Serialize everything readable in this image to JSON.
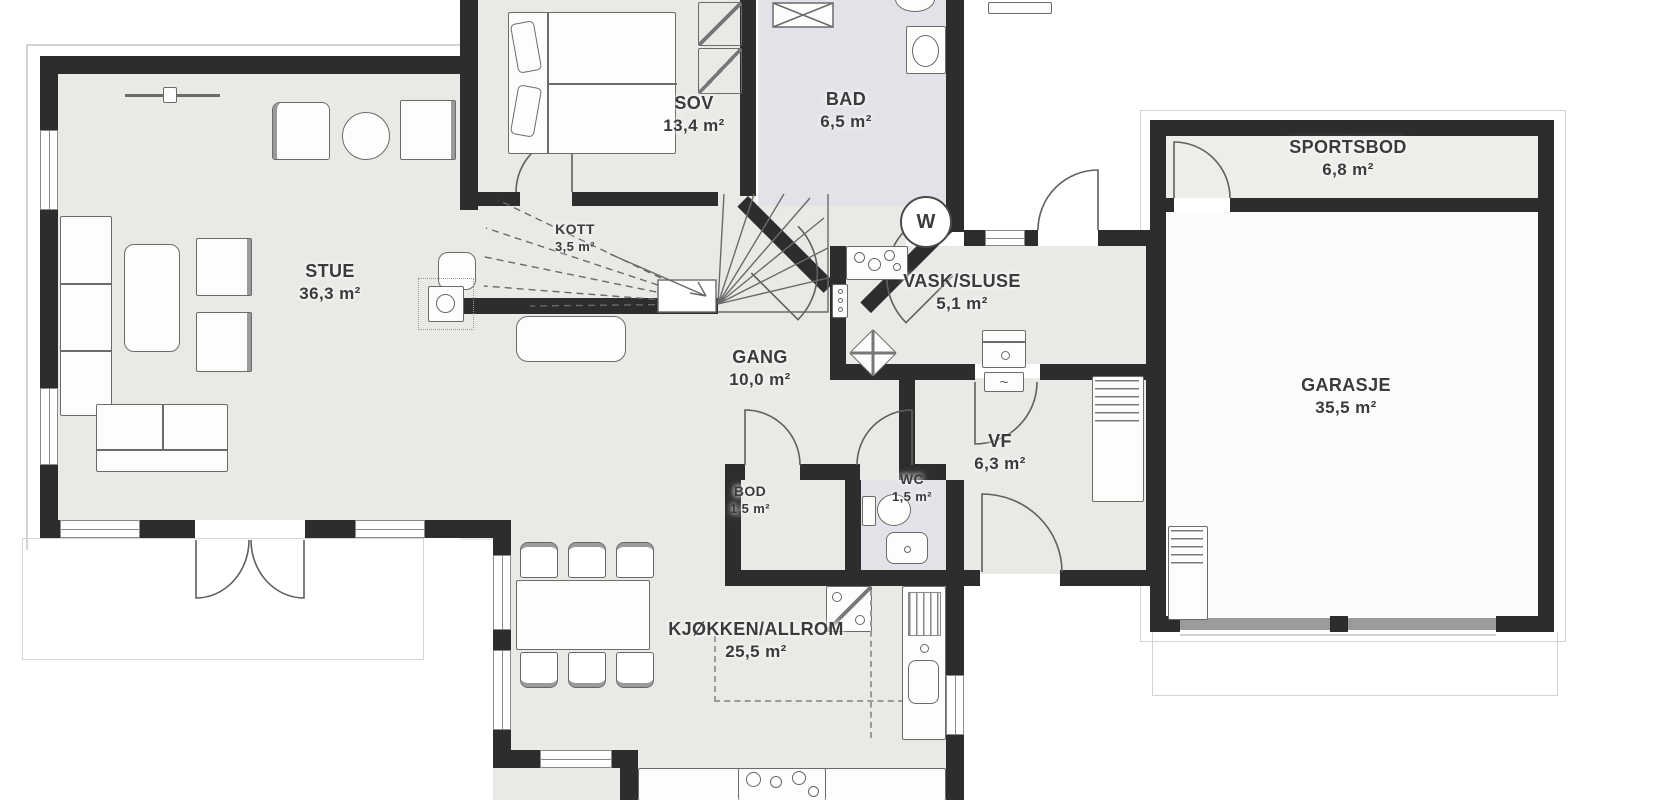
{
  "rooms": {
    "stue": {
      "label": "STUE",
      "area": "36,3 m²"
    },
    "sov": {
      "label": "SOV",
      "area": "13,4 m²"
    },
    "bad": {
      "label": "BAD",
      "area": "6,5 m²"
    },
    "kott": {
      "label": "KOTT",
      "area": "3,5 m²"
    },
    "gang": {
      "label": "GANG",
      "area": "10,0 m²"
    },
    "vask": {
      "label": "VASK/SLUSE",
      "area": "5,1 m²"
    },
    "vf": {
      "label": "VF",
      "area": "6,3 m²"
    },
    "wc": {
      "label": "WC",
      "area": "1,5 m²"
    },
    "bod": {
      "label": "BOD",
      "area": "1,5 m²"
    },
    "kjokken": {
      "label": "KJØKKEN/ALLROM",
      "area": "25,5 m²"
    },
    "sportsbod": {
      "label": "SPORTSBOD",
      "area": "6,8 m²"
    },
    "garasje": {
      "label": "GARASJE",
      "area": "35,5 m²"
    }
  },
  "symbols": {
    "washing_machine": "W"
  },
  "colors": {
    "wall": "#2d2d2d",
    "floor": "#e9e9e6",
    "wet_room_floor": "#e2e3e8",
    "garage_floor": "#fbfbf9",
    "sportsbod_floor": "#ededea",
    "outside": "#ffffff",
    "furniture_line": "#6b6b6b",
    "outline": "#d4d4d1",
    "text": "#3b3b3b"
  }
}
